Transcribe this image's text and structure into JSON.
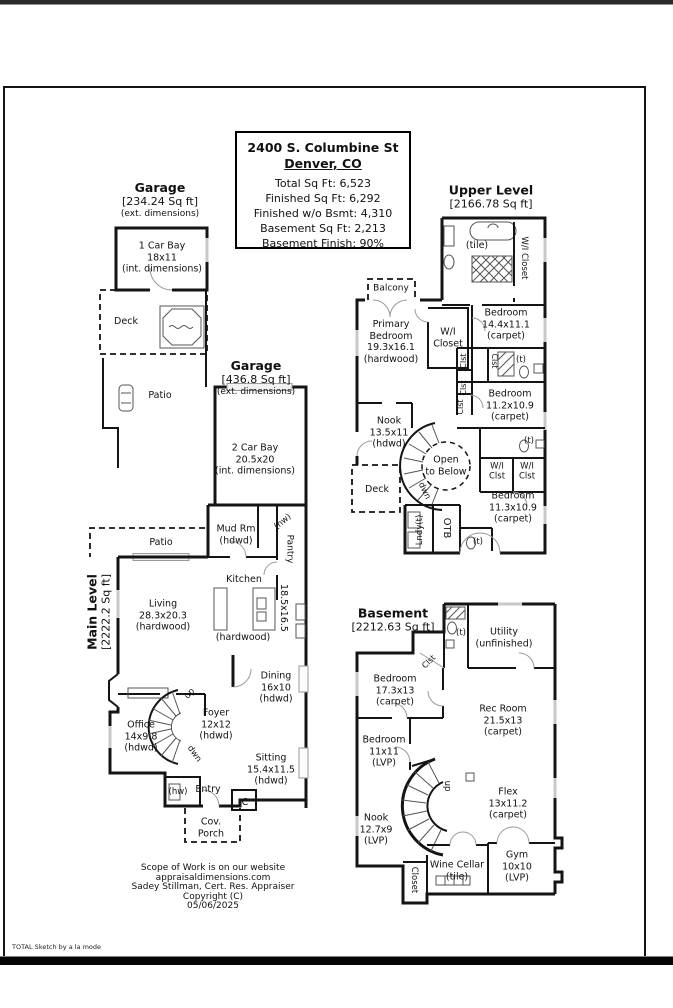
{
  "page": {
    "branding": "TOTAL Sketch by a la mode"
  },
  "summary": {
    "address": "2400 S. Columbine St",
    "city": "Denver, CO",
    "stats": [
      "Total Sq Ft: 6,523",
      "Finished Sq Ft: 6,292",
      "Finished w/o Bsmt: 4,310",
      "Basement Sq Ft: 2,213",
      "Basement Finish: 90%"
    ]
  },
  "garage1": {
    "title": "Garage",
    "sqft": "[234.24 Sq ft]",
    "note": "(ext. dimensions)",
    "bay": [
      "1 Car Bay",
      "18x11",
      "(int. dimensions)"
    ]
  },
  "garage2": {
    "title": "Garage",
    "sqft": "[436.8 Sq ft]",
    "note": "(ext. dimensions)",
    "bay": [
      "2 Car Bay",
      "20.5x20",
      "(int. dimensions)"
    ]
  },
  "upper": {
    "title": "Upper Level",
    "sqft": "[2166.78 Sq ft]",
    "rooms": {
      "bath_tile": "(tile)",
      "wi_closet_top": "W/I Closet",
      "balcony": "Balcony",
      "primary": [
        "Primary",
        "Bedroom",
        "19.3x16.1",
        "(hardwood)"
      ],
      "wi_closet": [
        "W/I",
        "Closet"
      ],
      "bed_14": [
        "Bedroom",
        "14.4x11.1",
        "(carpet)"
      ],
      "clst": "Clst",
      "t": "(t)",
      "bed_112": [
        "Bedroom",
        "11.2x10.9",
        "(carpet)"
      ],
      "nook": [
        "Nook",
        "13.5x11",
        "(hdwd)"
      ],
      "open_to_below": [
        "Open",
        "to Below"
      ],
      "dwn": "dwn",
      "deck": "Deck",
      "wi_clst": [
        "W/I",
        "Clst"
      ],
      "bed_113": [
        "Bedroom",
        "11.3x10.9",
        "(carpet)"
      ],
      "laundry": "Lndy(t)",
      "otb": "OTB"
    }
  },
  "main": {
    "title": "Main Level",
    "sqft": "[2222.2 Sq ft]",
    "rooms": {
      "deck": "Deck",
      "patio": "Patio",
      "mud": [
        "Mud Rm",
        "(hdwd)"
      ],
      "hw": "(hw)",
      "pantry": "Pantry",
      "kitchen": "Kitchen",
      "living": [
        "Living",
        "28.3x20.3",
        "(hardwood)"
      ],
      "kitchen_dims": "18.5x16.5",
      "kitchen_floor": "(hardwood)",
      "dining": [
        "Dining",
        "16x10",
        "(hdwd)"
      ],
      "foyer": [
        "Foyer",
        "12x12",
        "(hdwd)"
      ],
      "up": "up",
      "dwn": "dwn",
      "office": [
        "Office",
        "14x9.8",
        "(hdwd)"
      ],
      "sitting": [
        "Sitting",
        "15.4x11.5",
        "(hdwd)"
      ],
      "entry": "Entry",
      "closet": "C",
      "porch": [
        "Cov.",
        "Porch"
      ]
    }
  },
  "basement": {
    "title": "Basement",
    "sqft": "[2212.63 Sq ft]",
    "rooms": {
      "t": "(t)",
      "utility": [
        "Utility",
        "(unfinished)"
      ],
      "clst": "Clst",
      "bed_173": [
        "Bedroom",
        "17.3x13",
        "(carpet)"
      ],
      "rec": [
        "Rec Room",
        "21.5x13",
        "(carpet)"
      ],
      "bed_11": [
        "Bedroom",
        "11x11",
        "(LVP)"
      ],
      "up": "up",
      "flex": [
        "Flex",
        "13x11.2",
        "(carpet)"
      ],
      "nook": [
        "Nook",
        "12.7x9",
        "(LVP)"
      ],
      "wine": [
        "Wine Cellar",
        "(tile)"
      ],
      "gym": [
        "Gym",
        "10x10",
        "(LVP)"
      ],
      "closet": "Closet"
    }
  },
  "footer": {
    "lines": [
      "Scope of Work is on our website",
      "appraisaldimensions.com",
      "Sadey Stillman, Cert. Res. Appraiser",
      "Copyright (C)",
      "05/06/2025"
    ]
  }
}
